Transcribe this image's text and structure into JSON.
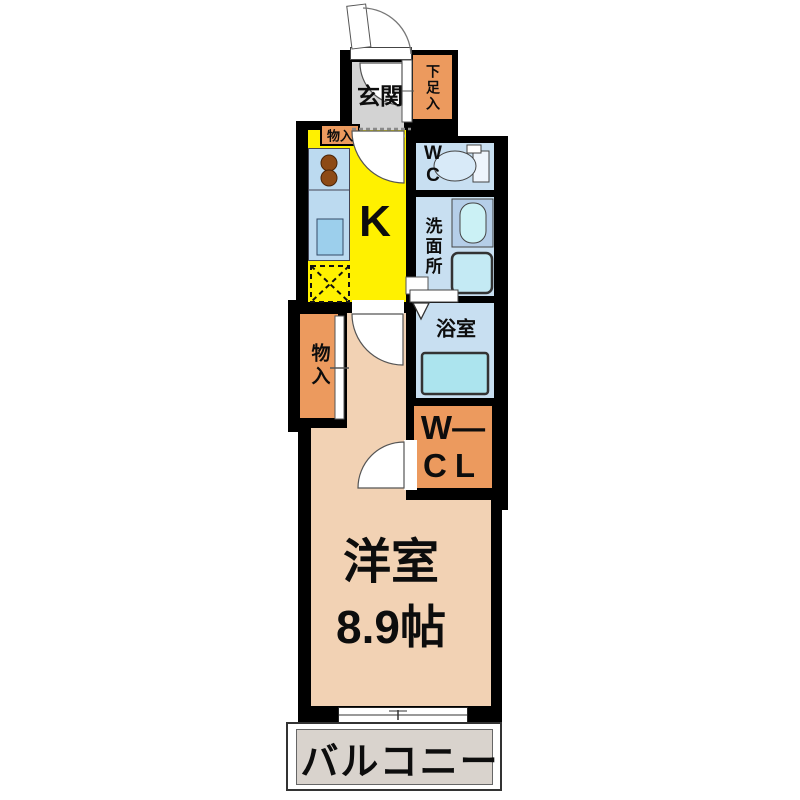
{
  "floorplan": {
    "rooms": {
      "entrance": {
        "label": "玄関"
      },
      "shoe_storage": {
        "label": "下足入"
      },
      "kitchen": {
        "label": "K"
      },
      "kitchen_storage": {
        "label": "物入"
      },
      "toilet_room": {
        "line1": "W",
        "line2": "C"
      },
      "washroom": {
        "label": "洗面所"
      },
      "bathroom": {
        "label": "浴室"
      },
      "closet": {
        "label": "物入"
      },
      "walk_in_closet": {
        "line1": "W—",
        "line2": "CL"
      },
      "western_room": {
        "name": "洋室",
        "size": "8.9帖"
      },
      "balcony": {
        "label": "バルコニー"
      }
    },
    "colors": {
      "wall": "#000000",
      "kitchen_yellow": "#fff100",
      "wet_room_blue": "#c8dff1",
      "counter_blue": "#bcdaf0",
      "storage_orange": "#ec9a5e",
      "western_room_peach": "#f2d2b4",
      "entrance_gray": "#d3d3d3",
      "balcony_gray": "#d9d3cd",
      "fixture_cyan": "#c4eaf4",
      "burner_brown": "#8d4a16"
    },
    "fixtures": [
      "entrance-door-swing",
      "interior-door-swings",
      "toilet",
      "vanity-sink",
      "washing-machine",
      "bathtub",
      "stove-burners",
      "kitchen-sink",
      "refrigerator-space",
      "sliding-closet-door",
      "folding-bath-door",
      "sliding-window"
    ]
  }
}
